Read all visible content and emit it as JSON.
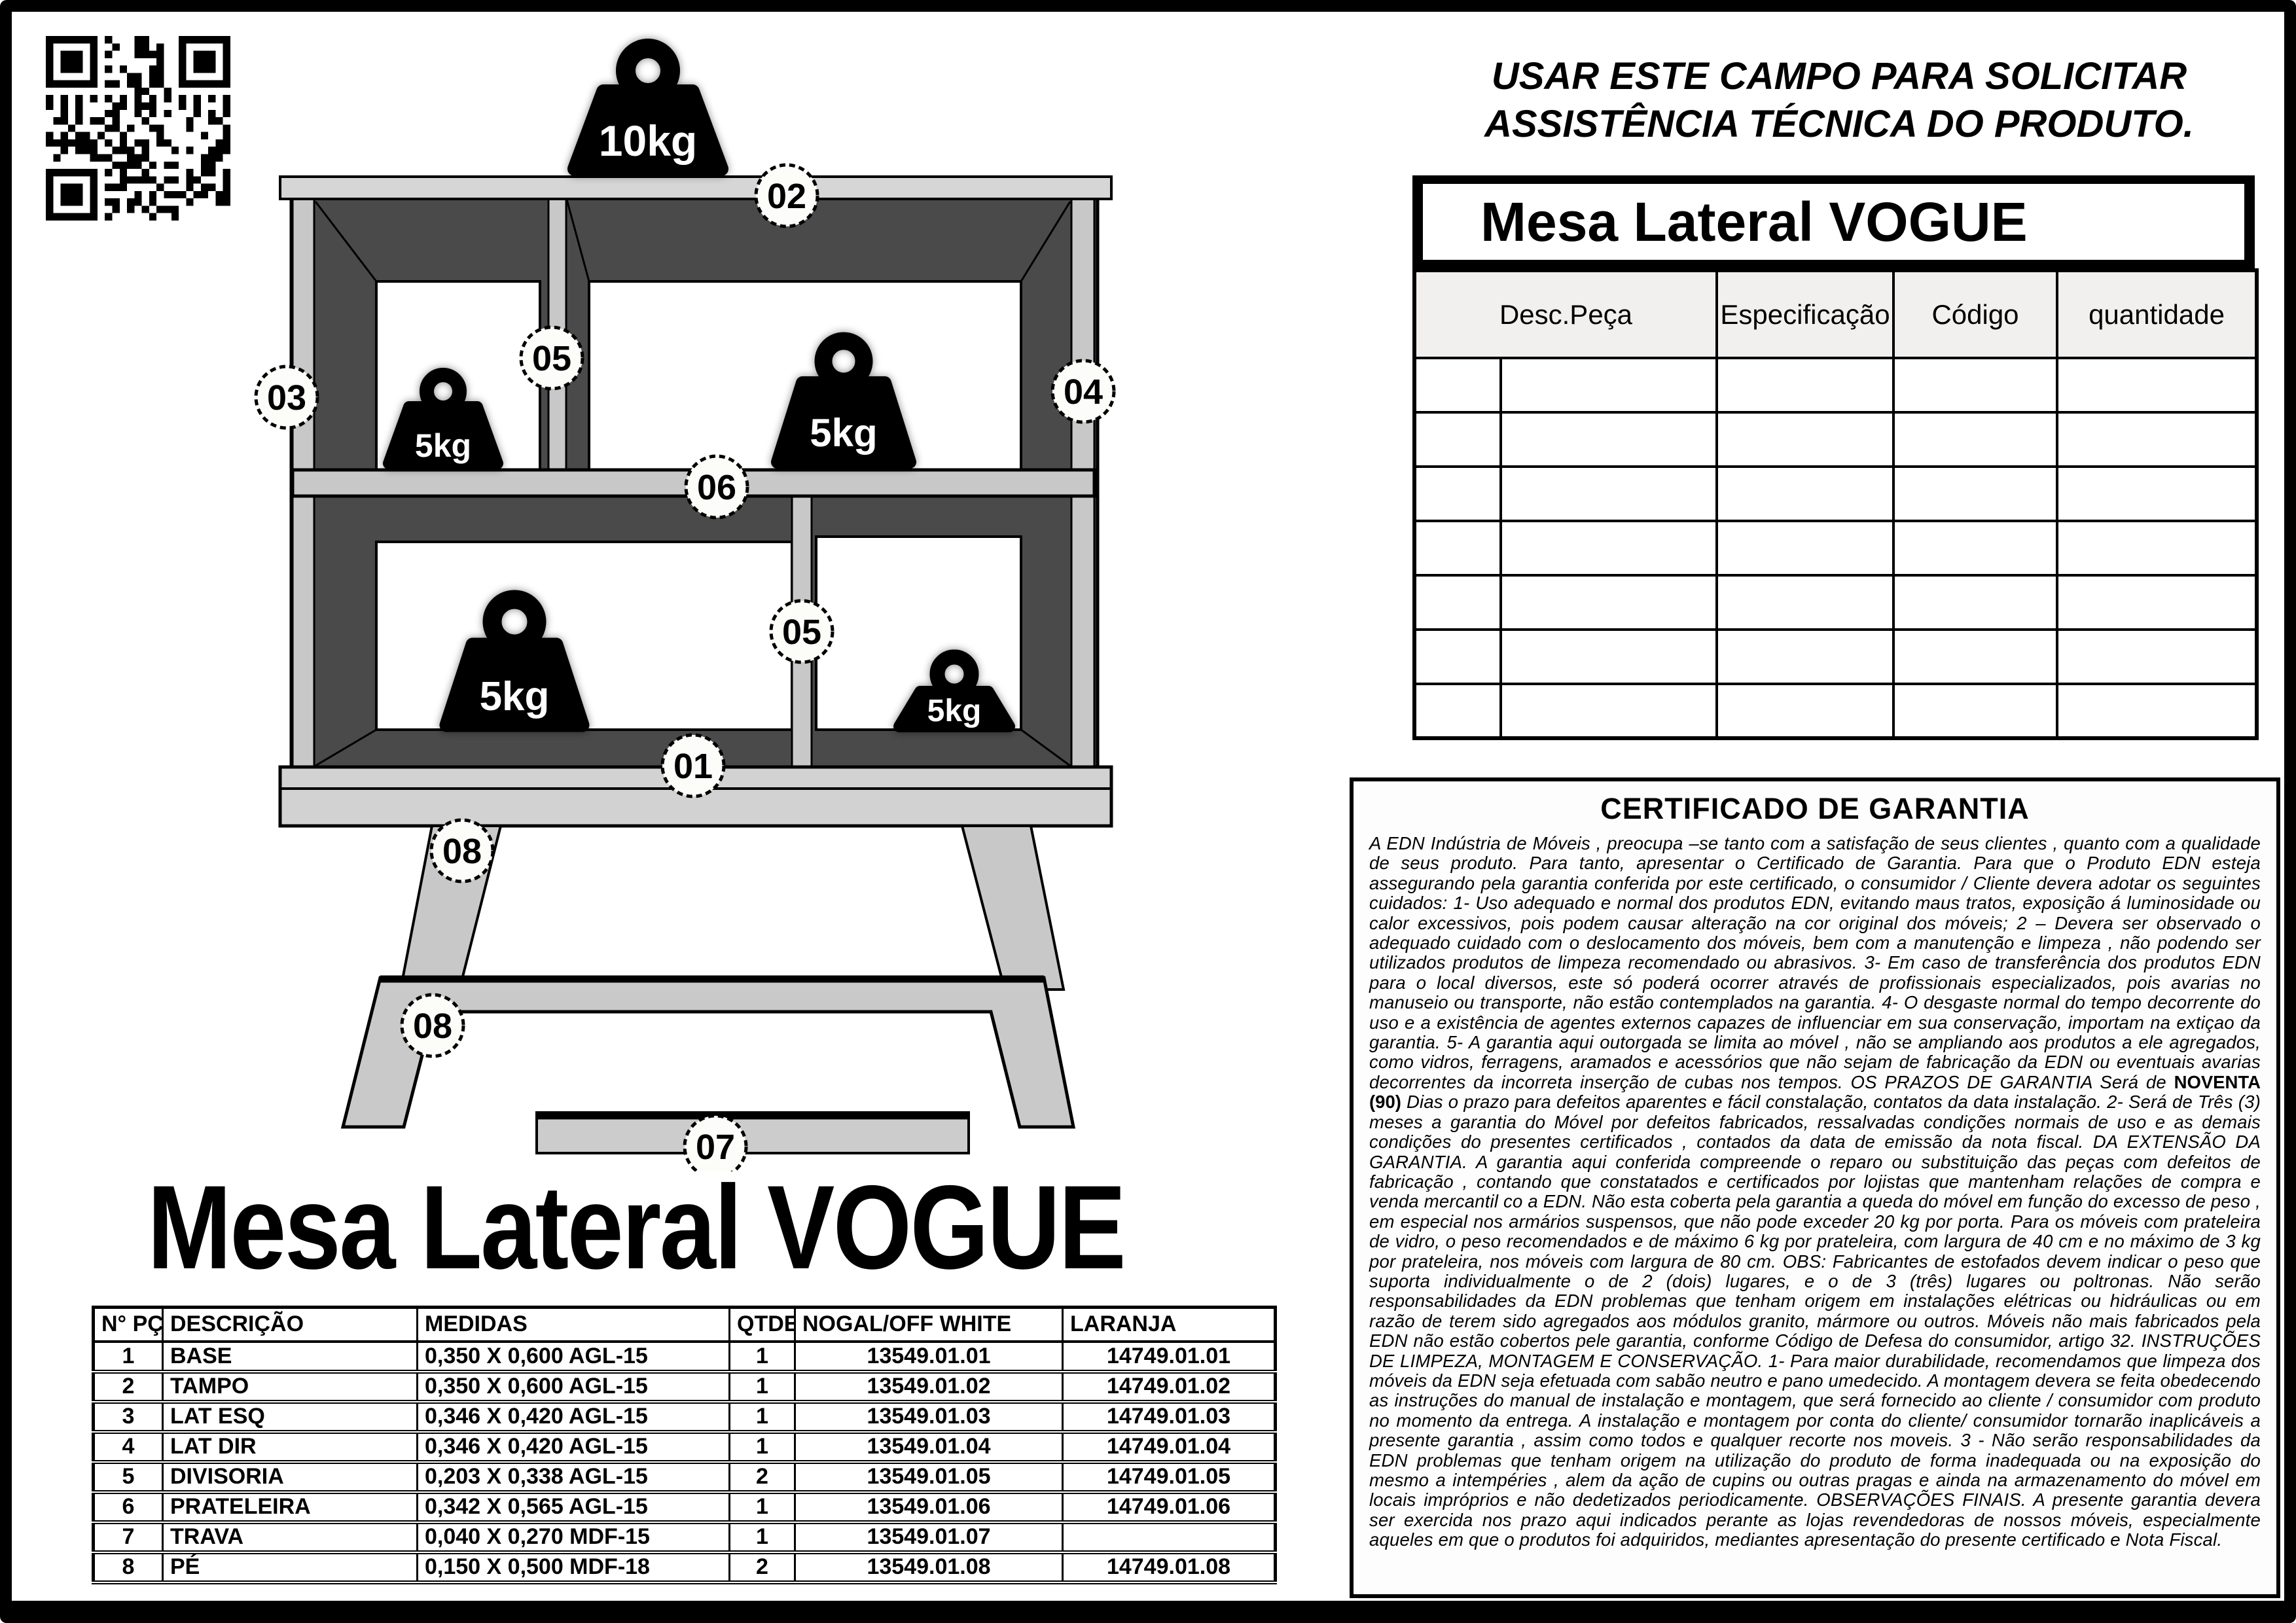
{
  "page_title": "Mesa Lateral VOGUE",
  "service_note": {
    "line1": "USAR ESTE CAMPO  PARA  SOLICITAR",
    "line2": "ASSISTÊNCIA  TÉCNICA DO PRODUTO."
  },
  "service_table": {
    "title": "Mesa Lateral VOGUE",
    "columns": [
      "Desc.Peça",
      "Especificação",
      "Código",
      "quantidade"
    ],
    "empty_row_count": 7
  },
  "diagram": {
    "weights": {
      "top": "10kg",
      "upper_left": "5kg",
      "upper_right": "5kg",
      "lower_left": "5kg",
      "lower_right": "5kg"
    },
    "callouts": {
      "base": "01",
      "top_panel": "02",
      "left_side": "03",
      "right_side": "04",
      "divider_upper": "05",
      "divider_lower": "05",
      "shelf": "06",
      "trava": "07",
      "leg_attached": "08",
      "leg_part": "08"
    }
  },
  "parts_table": {
    "columns": [
      "N° PÇ",
      "DESCRIÇÃO",
      "MEDIDAS",
      "QTDE",
      "NOGAL/OFF WHITE",
      "LARANJA"
    ],
    "rows": [
      {
        "num": "1",
        "desc": "BASE",
        "med": "0,350 X 0,600 AGL-15",
        "qtde": "1",
        "nogal": "13549.01.01",
        "laranja": "14749.01.01"
      },
      {
        "num": "2",
        "desc": "TAMPO",
        "med": "0,350 X 0,600 AGL-15",
        "qtde": "1",
        "nogal": "13549.01.02",
        "laranja": "14749.01.02"
      },
      {
        "num": "3",
        "desc": "LAT ESQ",
        "med": "0,346 X 0,420 AGL-15",
        "qtde": "1",
        "nogal": "13549.01.03",
        "laranja": "14749.01.03"
      },
      {
        "num": "4",
        "desc": "LAT DIR",
        "med": "0,346 X 0,420 AGL-15",
        "qtde": "1",
        "nogal": "13549.01.04",
        "laranja": "14749.01.04"
      },
      {
        "num": "5",
        "desc": "DIVISORIA",
        "med": "0,203 X 0,338 AGL-15",
        "qtde": "2",
        "nogal": "13549.01.05",
        "laranja": "14749.01.05"
      },
      {
        "num": "6",
        "desc": "PRATELEIRA",
        "med": "0,342 X 0,565 AGL-15",
        "qtde": "1",
        "nogal": "13549.01.06",
        "laranja": "14749.01.06"
      },
      {
        "num": "7",
        "desc": "TRAVA",
        "med": "0,040 X 0,270 MDF-15",
        "qtde": "1",
        "nogal": "13549.01.07",
        "laranja": ""
      },
      {
        "num": "8",
        "desc": "PÉ",
        "med": "0,150 X 0,500 MDF-18",
        "qtde": "2",
        "nogal": "13549.01.08",
        "laranja": "14749.01.08"
      }
    ]
  },
  "warranty": {
    "title": "CERTIFICADO DE GARANTIA",
    "body_part1": "A EDN Indústria de Móveis , preocupa –se tanto com a satisfação de seus clientes , quanto com a qualidade de seus produto. Para tanto, apresentar o Certificado de Garantia. Para que o Produto EDN esteja assegurando pela garantia conferida por este certificado, o consumidor / Cliente devera adotar os seguintes cuidados: 1- Uso adequado e normal dos produtos EDN, evitando maus tratos, exposição á luminosidade ou calor excessivos, pois podem causar alteração na cor original dos móveis; 2 – Devera ser observado o adequado cuidado com o deslocamento dos móveis, bem com a manutenção e limpeza , não podendo ser utilizados produtos de limpeza recomendado ou abrasivos.  3- Em caso de transferência dos produtos EDN para o local diversos, este só poderá ocorrer através de profissionais especializados, pois avarias no manuseio ou transporte, não estão contemplados na garantia. 4- O desgaste normal do tempo decorrente do uso e a existência de agentes externos capazes de influenciar em sua conservação, importam na extiçao da garantia. 5- A garantia aqui outorgada se limita ao móvel , não se ampliando aos produtos a ele agregados, como vidros, ferragens, aramados e acessórios que não sejam de fabricação da EDN ou eventuais avarias decorrentes da incorreta inserção de cubas nos tempos. OS PRAZOS DE GARANTIA Será de ",
    "bold_text": "NOVENTA (90)",
    "body_part2": " Dias o prazo para defeitos aparentes e fácil constalação, contatos da data instalação. 2- Será de Três (3) meses a garantia do Móvel por defeitos fabricados, ressalvadas condições normais de uso e as demais condições do presentes certificados , contados da data de emissão da nota fiscal. DA EXTENSÃO DA GARANTIA. A garantia aqui conferida compreende o reparo ou substituição das peças com defeitos de fabricação , contando que constatados e certificados por lojistas que mantenham relações de compra e venda mercantil co a EDN. Não esta coberta pela garantia a queda do móvel em função do excesso de peso , em especial nos armários suspensos, que não pode exceder 20 kg por porta. Para os móveis com prateleira de vidro, o peso recomendados e de máximo 6 kg por prateleira, com largura de 40 cm e no máximo de 3 kg por prateleira, nos móveis com largura de 80 cm. OBS: Fabricantes de estofados devem indicar o peso que suporta individualmente o de 2 (dois) lugares, e o de 3 (três) lugares ou poltronas. Não serão responsabilidades da EDN problemas que tenham origem em instalações elétricas ou hidráulicas ou em razão de terem sido agregados aos módulos granito, mármore ou outros. Móveis não mais fabricados pela EDN não estão cobertos pele garantia, conforme Código de Defesa do consumidor, artigo 32. INSTRUÇÕES DE LIMPEZA, MONTAGEM E CONSERVAÇÃO. 1- Para maior durabilidade, recomendamos que limpeza dos móveis da EDN seja efetuada com sabão neutro e pano umedecido. A montagem devera se feita obedecendo as instruções do manual de instalação e montagem, que será fornecido ao cliente / consumidor com produto no momento da entrega. A instalação e montagem por conta do cliente/ consumidor tornarão inaplicáveis a presente garantia , assim como todos e qualquer recorte nos moveis. 3 - Não serão responsabilidades da EDN problemas que tenham origem na utilização do produto de forma inadequada ou na exposição do mesmo a intempéries , alem da ação de cupins ou outras pragas e ainda na armazenamento do móvel em locais impróprios e não dedetizados periodicamente. OBSERVAÇÕES FINAIS. A presente garantia devera ser exercida nos prazo aqui indicados perante as lojas revendedoras de nossos móveis, especialmente aqueles em que o produtos foi adquiridos, mediantes apresentação do presente certificado e Nota Fiscal."
  },
  "colors": {
    "panel_light": "#cfcfcf",
    "panel_lighter": "#e2e2e2",
    "interior_dark": "#4a4a4a",
    "header_fill": "#f1f0ee",
    "frame": "#000000"
  }
}
